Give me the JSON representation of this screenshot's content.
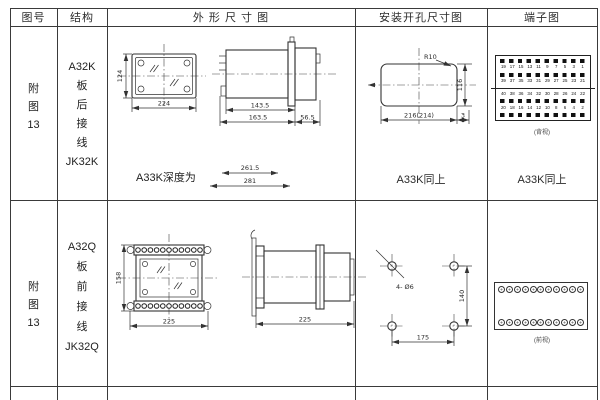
{
  "header": {
    "fig_no": "图号",
    "structure": "结构",
    "outline": "外 形 尺 寸 图",
    "install": "安装开孔尺寸图",
    "terminal": "端子图"
  },
  "rows": [
    {
      "fig_lines": [
        "附",
        "图",
        "13"
      ],
      "structure_lines": [
        "A32K",
        "板",
        "后",
        "接",
        "线",
        "JK32K"
      ],
      "outline": {
        "front_height": "124",
        "front_width": "224",
        "side_dim1": "143.5",
        "side_dim2": "163.5",
        "side_dim3": "56.5",
        "depth_label": "A33K深度为",
        "depth_dim1": "261.5",
        "depth_dim2": "281"
      },
      "install": {
        "radius": "R10",
        "cutout_height": "116",
        "cutout_width": "216(214)",
        "edge": "3",
        "same_as": "A33K同上"
      },
      "terminal": {
        "num_rows": [
          [
            "19",
            "17",
            "15",
            "13",
            "11",
            "9",
            "7",
            "5",
            "3",
            "1"
          ],
          [
            "39",
            "37",
            "35",
            "33",
            "31",
            "29",
            "27",
            "25",
            "23",
            "21"
          ],
          [
            "40",
            "38",
            "36",
            "34",
            "32",
            "30",
            "28",
            "26",
            "24",
            "22"
          ],
          [
            "20",
            "18",
            "16",
            "14",
            "12",
            "10",
            "8",
            "6",
            "4",
            "2"
          ]
        ],
        "caption": "(背视)",
        "same_as": "A33K同上"
      }
    },
    {
      "fig_lines": [
        "附",
        "图",
        "13"
      ],
      "structure_lines": [
        "A32Q",
        "板",
        "前",
        "接",
        "线",
        "JK32Q"
      ],
      "outline": {
        "front_height": "158",
        "front_width": "225",
        "side_width": "225"
      },
      "install": {
        "holes": "4- Ø6",
        "hole_span_w": "175",
        "hole_span_h": "140"
      },
      "terminal": {
        "circles_per_row": 11,
        "caption": "(前视)"
      }
    }
  ]
}
